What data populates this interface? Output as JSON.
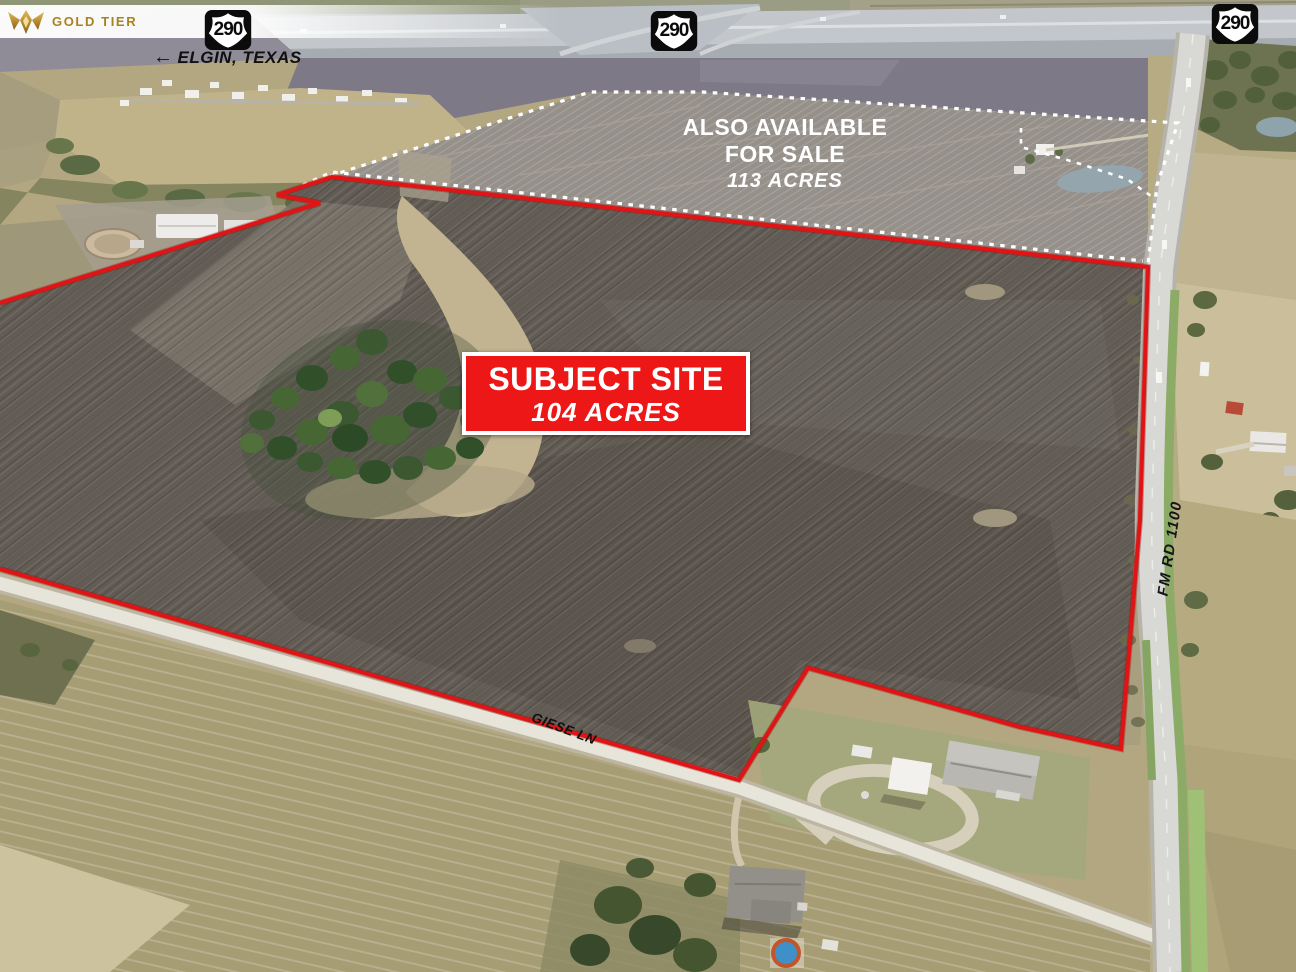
{
  "branding": {
    "label": "GOLD TIER"
  },
  "route_shields": [
    {
      "label": "290"
    },
    {
      "label": "290"
    },
    {
      "label": "290"
    }
  ],
  "direction_note": {
    "arrow": "←",
    "label": "ELGIN, TEXAS"
  },
  "also_available": {
    "line1": "ALSO AVAILABLE",
    "line2": "FOR SALE",
    "acres": "113 ACRES"
  },
  "subject_site": {
    "title": "SUBJECT SITE",
    "acres": "104 ACRES"
  },
  "roads": {
    "fm_label": "FM RD 1100",
    "giese_label": "GIESE LN"
  },
  "colors": {
    "boundary_red": "#e01414",
    "available_boundary_white": "#ffffff",
    "subject_box_bg": "#ed1717",
    "gold": "#a8821e"
  }
}
